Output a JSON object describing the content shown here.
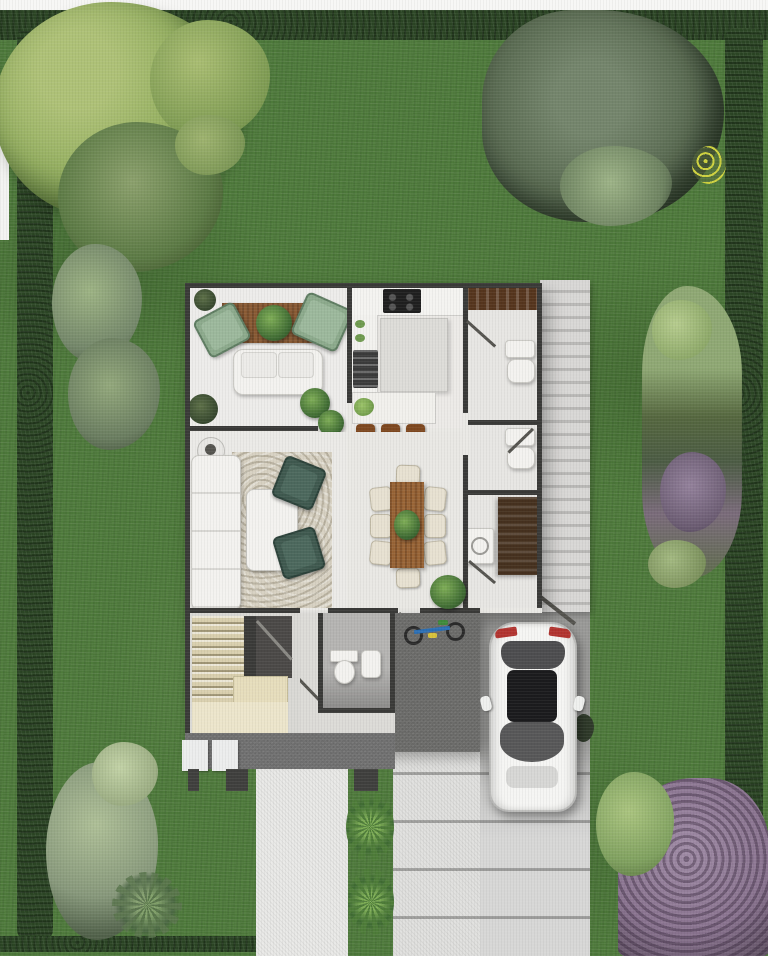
{
  "scene": {
    "title": "Top-view 3D floor plan of a house with garden, driveway and parked car",
    "type": "architectural-site-plan"
  },
  "palette": {
    "lawn": "#4e7a3b",
    "hedge": "#2b4524",
    "tree_light": "#97b163",
    "bush_gray": "#5a6a52",
    "shrub_gray": "#8a9a7a",
    "purple_bush": "#8a7490",
    "floor": "#eae9e5",
    "wall": "#3a3a38",
    "rug_brown": "#8a5b35",
    "rug_living": "#d7d1c2",
    "wood": "#996537",
    "stairs": "#d9cfae",
    "porch": "#707070",
    "patio": "#6b6b69",
    "driveway_upper": "#a6a6a4",
    "driveway_lower": "#e0e0de",
    "walkway": "#e9e9e7",
    "car_body": "#f5f5f3",
    "car_glass": "#2f2f31",
    "taillight": "#b23430"
  },
  "garden": {
    "hedges": [
      "top",
      "left",
      "right",
      "bottom-left"
    ],
    "plants": [
      {
        "name": "large-tree",
        "position": "top-left"
      },
      {
        "name": "undergrowth-shrubs",
        "position": "below-large-tree"
      },
      {
        "name": "gray-green-bush",
        "position": "top-right"
      },
      {
        "name": "shrub-cluster-upper",
        "position": "left-edge"
      },
      {
        "name": "shrub-cluster-lower",
        "position": "left-edge"
      },
      {
        "name": "flower-bed",
        "position": "right-edge"
      },
      {
        "name": "shrub-cluster",
        "position": "bottom-left"
      },
      {
        "name": "purple-flowering-bush",
        "position": "bottom-right"
      },
      {
        "name": "agave-upper",
        "position": "between-walkway-and-driveway"
      },
      {
        "name": "agave-lower",
        "position": "between-walkway-and-driveway"
      }
    ]
  },
  "house": {
    "rooms": [
      {
        "name": "sitting-room",
        "furniture": [
          "brown-area-rug",
          "centerpiece-plant",
          "sage-armchair-left",
          "sage-armchair-right",
          "white-loveseat",
          "corner-plants"
        ]
      },
      {
        "name": "kitchen",
        "furniture": [
          "cooktop",
          "counters",
          "island",
          "breakfast-bar",
          "bar-stool",
          "bar-stool",
          "bar-stool",
          "oven"
        ]
      },
      {
        "name": "entry-hall",
        "furniture": [
          "console-shelf"
        ]
      },
      {
        "name": "living-room",
        "furniture": [
          "white-sectional-sofa",
          "beige-area-rug",
          "coffee-table",
          "teal-armchair-upper",
          "teal-armchair-lower",
          "side-table-with-lamp"
        ]
      },
      {
        "name": "dining-room",
        "furniture": [
          "wood-dining-table",
          "centerpiece-plant",
          "eight-cream-chairs"
        ]
      },
      {
        "name": "bathroom",
        "furniture": [
          "sink",
          "toilet"
        ]
      },
      {
        "name": "utility-room",
        "furniture": [
          "dark-vanity",
          "washer"
        ]
      },
      {
        "name": "stair-hall",
        "furniture": [
          "staircase",
          "landing"
        ]
      },
      {
        "name": "powder-room",
        "furniture": [
          "toilet",
          "sink"
        ]
      }
    ]
  },
  "exterior": {
    "side_path": "louvered-side-path",
    "porch": "rear-porch",
    "pavers": "stepping-pavers",
    "walkway": "front-walkway",
    "driveway": "concrete-driveway",
    "patio": "service-patio",
    "bicycle": "kids-bicycle-on-patio",
    "car": "white-hatchback-parked"
  }
}
